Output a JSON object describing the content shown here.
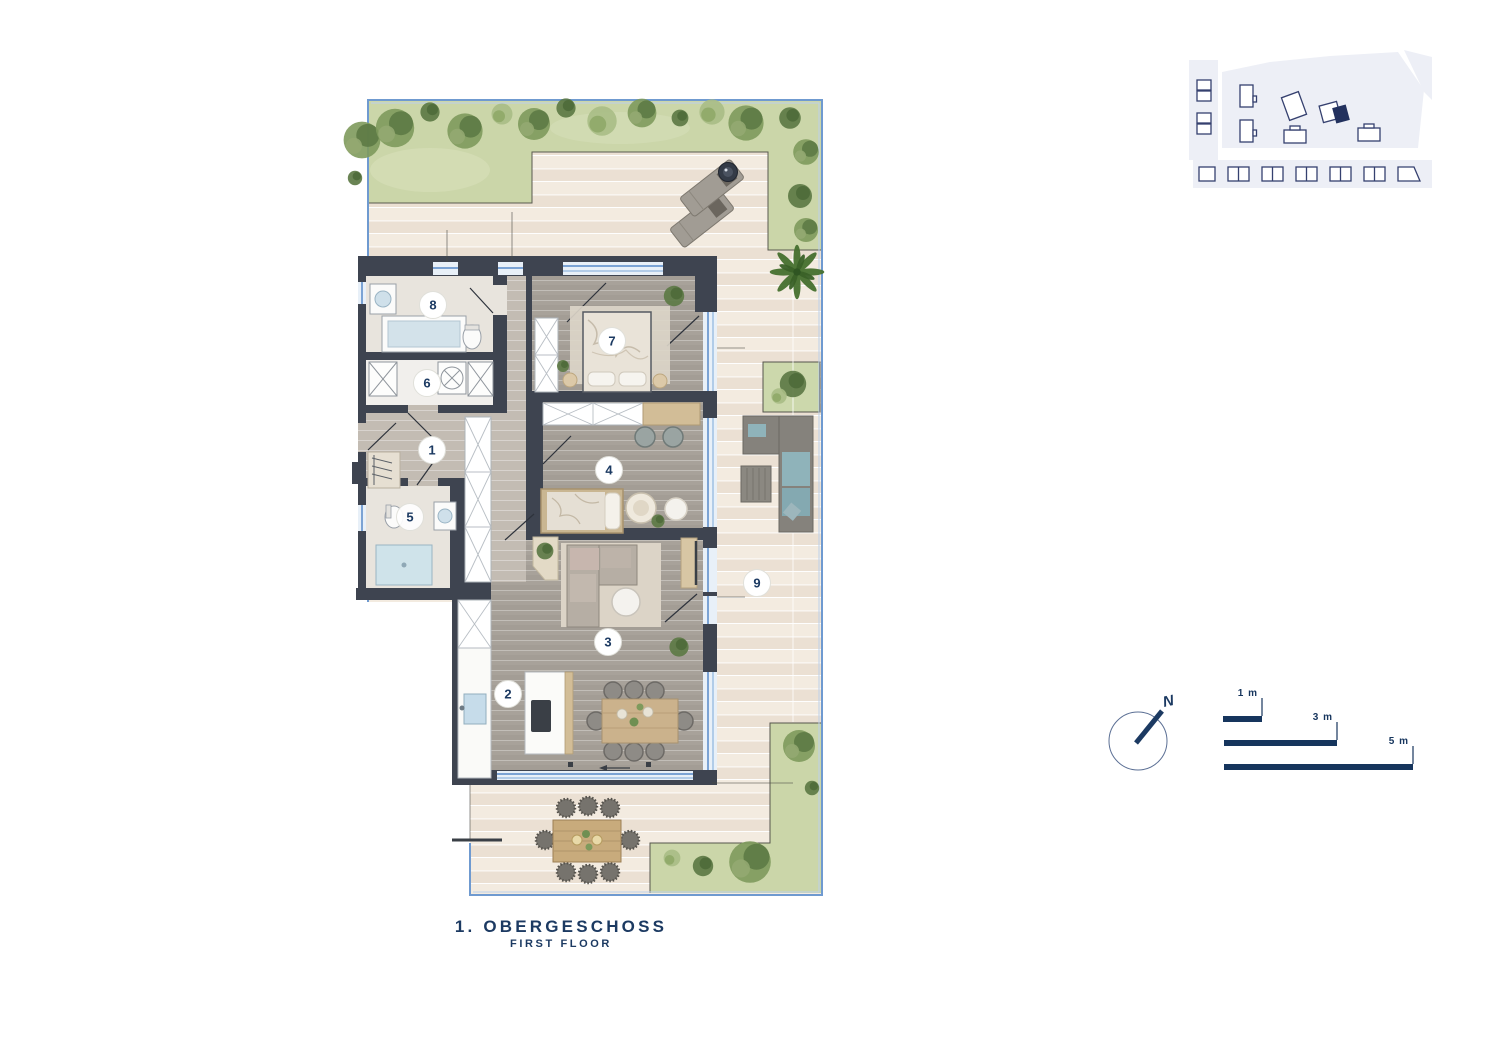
{
  "title": {
    "main": "1. OBERGESCHOSS",
    "sub": "FIRST FLOOR"
  },
  "rooms": [
    {
      "number": "1"
    },
    {
      "number": "2"
    },
    {
      "number": "3"
    },
    {
      "number": "4"
    },
    {
      "number": "5"
    },
    {
      "number": "6"
    },
    {
      "number": "7"
    },
    {
      "number": "8"
    },
    {
      "number": "9"
    }
  ],
  "compass": {
    "north": "N"
  },
  "scale_bars": [
    {
      "label": "1 m"
    },
    {
      "label": "3 m"
    },
    {
      "label": "5 m"
    }
  ],
  "colors": {
    "accent_navy": "#1c3a62",
    "wall_dark": "#3e4450",
    "boundary_blue": "#6f9ad0",
    "glazing_blue": "#bcd5ec",
    "deck_cream": "#f1e8dc",
    "grass_green": "#cbd6a9",
    "room_floor": "#a8a29a",
    "hall_floor": "#c3bcb3",
    "siteplan_fill": "#edeff6",
    "siteplan_outline": "#35406f"
  }
}
